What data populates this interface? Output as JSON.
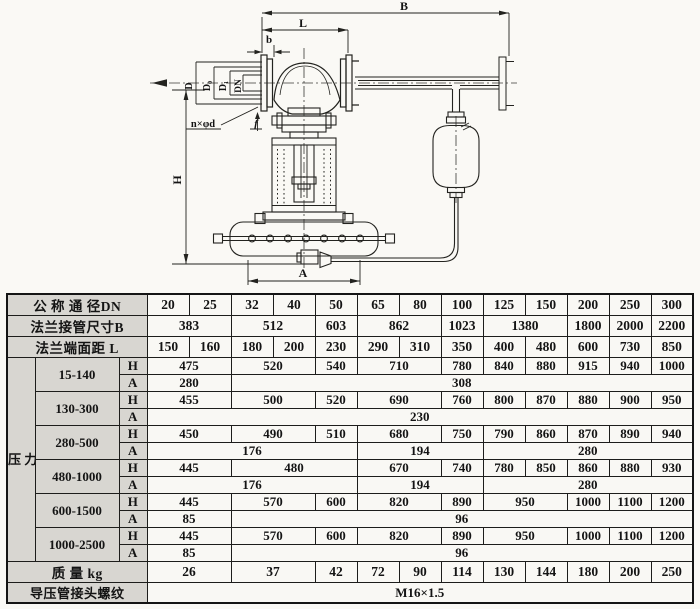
{
  "diagram": {
    "labels": {
      "B": "B",
      "L": "L",
      "b": "b",
      "D": "D",
      "D0": "D₀",
      "D1": "D₁",
      "DN": "DN",
      "bolt_spec": "n×φd",
      "f": "f",
      "H": "H",
      "A": "A"
    }
  },
  "table": {
    "rows": [
      {
        "cls": "hd",
        "cells": [
          {
            "t": "公 称 通 径DN",
            "cs": 3,
            "cls": "lab"
          },
          {
            "t": "20"
          },
          {
            "t": "25"
          },
          {
            "t": "32"
          },
          {
            "t": "40"
          },
          {
            "t": "50"
          },
          {
            "t": "65"
          },
          {
            "t": "80"
          },
          {
            "t": "100"
          },
          {
            "t": "125"
          },
          {
            "t": "150"
          },
          {
            "t": "200"
          },
          {
            "t": "250"
          },
          {
            "t": "300"
          }
        ]
      },
      {
        "cls": "hd",
        "cells": [
          {
            "t": "法兰接管尺寸B",
            "cs": 3,
            "cls": "lab"
          },
          {
            "t": "383",
            "cs": 2
          },
          {
            "t": "512",
            "cs": 2
          },
          {
            "t": "603"
          },
          {
            "t": "862",
            "cs": 2
          },
          {
            "t": "1023"
          },
          {
            "t": "1380",
            "cs": 2
          },
          {
            "t": "1800"
          },
          {
            "t": "2000"
          },
          {
            "t": "2200"
          }
        ]
      },
      {
        "cls": "hd",
        "cells": [
          {
            "t": "法兰端面距  L",
            "cs": 3,
            "cls": "lab"
          },
          {
            "t": "150"
          },
          {
            "t": "160"
          },
          {
            "t": "180"
          },
          {
            "t": "200"
          },
          {
            "t": "230"
          },
          {
            "t": "290"
          },
          {
            "t": "310"
          },
          {
            "t": "350"
          },
          {
            "t": "400"
          },
          {
            "t": "480"
          },
          {
            "t": "600"
          },
          {
            "t": "730"
          },
          {
            "t": "850"
          }
        ]
      },
      {
        "cls": "rh",
        "cells": [
          {
            "t": "压\n力\n调\n节\n范\n围\nKPa",
            "rs": 12,
            "cls": "vert"
          },
          {
            "t": "15-140",
            "rs": 2,
            "cls": "rng"
          },
          {
            "t": "H",
            "cls": "lab"
          },
          {
            "t": "475",
            "cs": 2
          },
          {
            "t": "520",
            "cs": 2
          },
          {
            "t": "540"
          },
          {
            "t": "710",
            "cs": 2
          },
          {
            "t": "780"
          },
          {
            "t": "840"
          },
          {
            "t": "880"
          },
          {
            "t": "915"
          },
          {
            "t": "940"
          },
          {
            "t": "1000"
          }
        ]
      },
      {
        "cls": "ra",
        "cells": [
          {
            "t": "A",
            "cls": "lab"
          },
          {
            "t": "280",
            "cs": 2
          },
          {
            "t": "308",
            "cs": 11
          }
        ]
      },
      {
        "cls": "rh",
        "cells": [
          {
            "t": "130-300",
            "rs": 2,
            "cls": "rng"
          },
          {
            "t": "H",
            "cls": "lab"
          },
          {
            "t": "455",
            "cs": 2
          },
          {
            "t": "500",
            "cs": 2
          },
          {
            "t": "520"
          },
          {
            "t": "690",
            "cs": 2
          },
          {
            "t": "760"
          },
          {
            "t": "800"
          },
          {
            "t": "870"
          },
          {
            "t": "880"
          },
          {
            "t": "900"
          },
          {
            "t": "950"
          }
        ]
      },
      {
        "cls": "ra",
        "cells": [
          {
            "t": "A",
            "cls": "lab"
          },
          {
            "t": "230",
            "cs": 13
          }
        ]
      },
      {
        "cls": "rh",
        "cells": [
          {
            "t": "280-500",
            "rs": 2,
            "cls": "rng"
          },
          {
            "t": "H",
            "cls": "lab"
          },
          {
            "t": "450",
            "cs": 2
          },
          {
            "t": "490",
            "cs": 2
          },
          {
            "t": "510"
          },
          {
            "t": "680",
            "cs": 2
          },
          {
            "t": "750"
          },
          {
            "t": "790"
          },
          {
            "t": "860"
          },
          {
            "t": "870"
          },
          {
            "t": "890"
          },
          {
            "t": "940"
          }
        ]
      },
      {
        "cls": "ra",
        "cells": [
          {
            "t": "A",
            "cls": "lab"
          },
          {
            "t": "176",
            "cs": 5
          },
          {
            "t": "194",
            "cs": 3
          },
          {
            "t": "280",
            "cs": 5
          }
        ]
      },
      {
        "cls": "rh",
        "cells": [
          {
            "t": "480-1000",
            "rs": 2,
            "cls": "rng"
          },
          {
            "t": "H",
            "cls": "lab"
          },
          {
            "t": "445",
            "cs": 2
          },
          {
            "t": "480",
            "cs": 3
          },
          {
            "t": "670",
            "cs": 2
          },
          {
            "t": "740"
          },
          {
            "t": "780"
          },
          {
            "t": "850"
          },
          {
            "t": "860"
          },
          {
            "t": "880"
          },
          {
            "t": "930"
          }
        ]
      },
      {
        "cls": "ra",
        "cells": [
          {
            "t": "A",
            "cls": "lab"
          },
          {
            "t": "176",
            "cs": 5
          },
          {
            "t": "194",
            "cs": 3
          },
          {
            "t": "280",
            "cs": 5
          }
        ]
      },
      {
        "cls": "rh",
        "cells": [
          {
            "t": "600-1500",
            "rs": 2,
            "cls": "rng"
          },
          {
            "t": "H",
            "cls": "lab"
          },
          {
            "t": "445",
            "cs": 2
          },
          {
            "t": "570",
            "cs": 2
          },
          {
            "t": "600"
          },
          {
            "t": "820",
            "cs": 2
          },
          {
            "t": "890"
          },
          {
            "t": "950",
            "cs": 2
          },
          {
            "t": "1000"
          },
          {
            "t": "1100"
          },
          {
            "t": "1200"
          }
        ]
      },
      {
        "cls": "ra",
        "cells": [
          {
            "t": "A",
            "cls": "lab"
          },
          {
            "t": "85",
            "cs": 2
          },
          {
            "t": "96",
            "cs": 11
          }
        ]
      },
      {
        "cls": "rh",
        "cells": [
          {
            "t": "1000-2500",
            "rs": 2,
            "cls": "rng"
          },
          {
            "t": "H",
            "cls": "lab"
          },
          {
            "t": "445",
            "cs": 2
          },
          {
            "t": "570",
            "cs": 2
          },
          {
            "t": "600"
          },
          {
            "t": "820",
            "cs": 2
          },
          {
            "t": "890"
          },
          {
            "t": "950",
            "cs": 2
          },
          {
            "t": "1000"
          },
          {
            "t": "1100"
          },
          {
            "t": "1200"
          }
        ]
      },
      {
        "cls": "ra",
        "cells": [
          {
            "t": "A",
            "cls": "lab"
          },
          {
            "t": "85",
            "cs": 2
          },
          {
            "t": "96",
            "cs": 11
          }
        ]
      },
      {
        "cls": "rm",
        "cells": [
          {
            "t": "质    量  kg",
            "cs": 3,
            "cls": "lab"
          },
          {
            "t": "26",
            "cs": 2
          },
          {
            "t": "37",
            "cs": 2
          },
          {
            "t": "42"
          },
          {
            "t": "72"
          },
          {
            "t": "90"
          },
          {
            "t": "114"
          },
          {
            "t": "130"
          },
          {
            "t": "144"
          },
          {
            "t": "180"
          },
          {
            "t": "200"
          },
          {
            "t": "250"
          }
        ]
      },
      {
        "cls": "rt",
        "cells": [
          {
            "t": "导压管接头螺纹",
            "cs": 3,
            "cls": "lab"
          },
          {
            "t": "M16×1.5",
            "cs": 13
          }
        ]
      }
    ]
  }
}
